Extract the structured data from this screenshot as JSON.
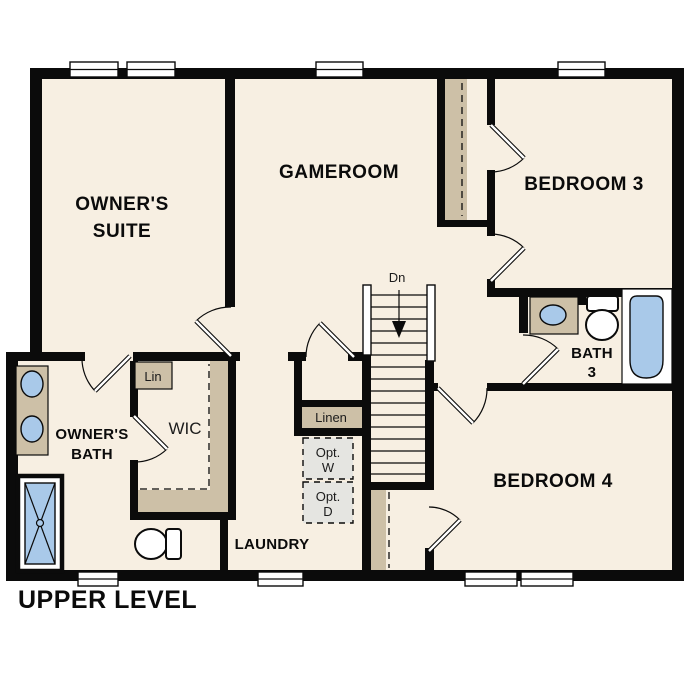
{
  "plan": {
    "level_label": "UPPER LEVEL",
    "rooms": {
      "owners_suite": {
        "l1": "OWNER'S",
        "l2": "SUITE"
      },
      "gameroom": {
        "l1": "GAMEROOM"
      },
      "bedroom3": {
        "l1": "BEDROOM 3"
      },
      "bedroom4": {
        "l1": "BEDROOM 4"
      },
      "bath3": {
        "l1": "BATH",
        "l2": "3"
      },
      "owners_bath": {
        "l1": "OWNER'S",
        "l2": "BATH"
      },
      "wic": {
        "l1": "WIC"
      },
      "laundry": {
        "l1": "LAUNDRY"
      }
    },
    "closets": {
      "lin": {
        "l1": "Lin"
      },
      "linen": {
        "l1": "Linen"
      },
      "opt_washer": {
        "l1": "Opt.",
        "l2": "W"
      },
      "opt_dryer": {
        "l1": "Opt.",
        "l2": "D"
      }
    },
    "stairs": {
      "direction_label": "Dn"
    },
    "colors": {
      "floor": "#f7efe2",
      "wall": "#0b0b0b",
      "cabinetry": "#cdc0a7",
      "fixture_blue": "#a9c9e9",
      "optional_appliance": "#e5e5e1",
      "background": "#ffffff"
    }
  }
}
